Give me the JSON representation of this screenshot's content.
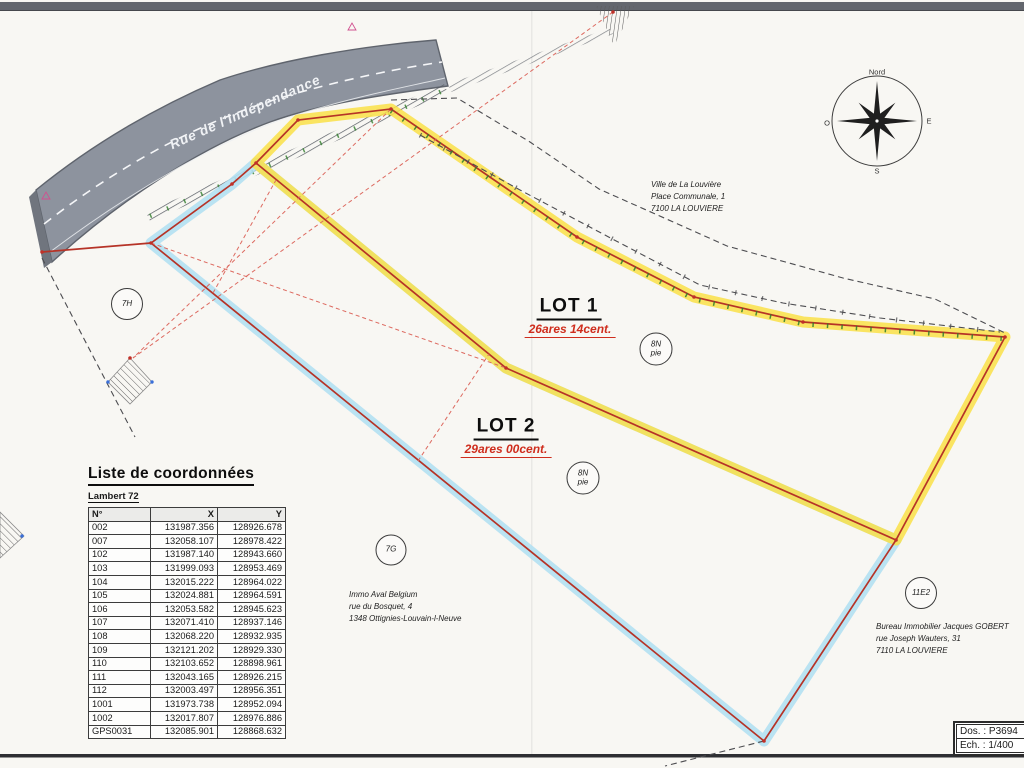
{
  "plan": {
    "road_name": "Rue de l'Indépendance",
    "dossier_label": "Dos. : P3694",
    "scale_label": "Ech. : 1/400",
    "compass": {
      "n": "Nord",
      "e": "E",
      "s": "S",
      "o": "O"
    },
    "lot1": {
      "name": "LOT 1",
      "area": "26ares 14cent."
    },
    "lot2": {
      "name": "LOT 2",
      "area": "29ares 00cent."
    }
  },
  "addresses": [
    {
      "l1": "Ville de La Louvière",
      "l2": "Place Communale, 1",
      "l3": "7100 LA LOUVIERE",
      "x": 651,
      "y": 179
    },
    {
      "l1": "Immo Aval Belgium",
      "l2": "rue du Bosquet, 4",
      "l3": "1348 Ottignies-Louvain-l-Neuve",
      "x": 349,
      "y": 589
    },
    {
      "l1": "Bureau Immobilier Jacques GOBERT",
      "l2": "rue Joseph Wauters, 31",
      "l3": "7110 LA LOUVIERE",
      "x": 876,
      "y": 621
    }
  ],
  "circles": [
    {
      "l1": "7H",
      "l2": "",
      "x": 127,
      "y": 304,
      "d": 30
    },
    {
      "l1": "7G",
      "l2": "",
      "x": 391,
      "y": 550,
      "d": 29
    },
    {
      "l1": "8N",
      "l2": "pie",
      "x": 656,
      "y": 349,
      "d": 31
    },
    {
      "l1": "8N",
      "l2": "pie",
      "x": 583,
      "y": 478,
      "d": 31
    },
    {
      "l1": "11E2",
      "l2": "",
      "x": 921,
      "y": 593,
      "d": 30
    }
  ],
  "labels": {
    "points": [
      {
        "t": "105 PL",
        "x": 401,
        "y": 98
      },
      {
        "t": "PL 104",
        "x": 312,
        "y": 106
      },
      {
        "t": "112 NBFJ",
        "x": 276,
        "y": 160
      },
      {
        "t": "à poser",
        "x": 279,
        "y": 170,
        "cls": "sm"
      },
      {
        "t": "103",
        "x": 222,
        "y": 189
      },
      {
        "t": "PL",
        "x": 220,
        "y": 198
      },
      {
        "t": "PL",
        "x": 120,
        "y": 238
      },
      {
        "t": "102",
        "x": 119,
        "y": 247
      },
      {
        "t": "PL",
        "x": 576,
        "y": 220
      },
      {
        "t": "106",
        "x": 589,
        "y": 228
      },
      {
        "t": "107",
        "x": 690,
        "y": 293
      },
      {
        "t": "PL",
        "x": 701,
        "y": 302
      },
      {
        "t": "108",
        "x": 799,
        "y": 317
      },
      {
        "t": "PL",
        "x": 803,
        "y": 327
      },
      {
        "t": "PL 109",
        "x": 1008,
        "y": 325
      },
      {
        "t": "110 NBFJ",
        "x": 926,
        "y": 544
      },
      {
        "t": "à poser",
        "x": 921,
        "y": 555,
        "cls": "sm"
      },
      {
        "t": "111 NBFJ",
        "x": 524,
        "y": 352
      },
      {
        "t": "à poser",
        "x": 527,
        "y": 362,
        "cls": "sm"
      },
      {
        "t": "GPS0031",
        "x": 802,
        "y": 744
      },
      {
        "t": "PL",
        "x": 787,
        "y": 753
      },
      {
        "t": "007",
        "x": 622,
        "y": 12
      },
      {
        "t": "Coin bât",
        "x": 631,
        "y": 22
      },
      {
        "t": "Coin bât",
        "x": 119,
        "y": 341
      },
      {
        "t": "002",
        "x": 113,
        "y": 350
      }
    ],
    "red_measures": [
      {
        "t": "9.88",
        "x": 344,
        "y": 114,
        "r": -8
      },
      {
        "t": "14.01",
        "x": 289,
        "y": 142,
        "r": -42
      },
      {
        "t": "5.26",
        "x": 233,
        "y": 172,
        "r": -39
      },
      {
        "t": "18.46",
        "x": 177,
        "y": 213,
        "r": -38
      },
      {
        "t": "6.17",
        "x": 113,
        "y": 261,
        "r": -47
      },
      {
        "t": "17.49",
        "x": 62,
        "y": 306,
        "r": -56
      },
      {
        "t": "20.00",
        "x": 254,
        "y": 262,
        "r": -56
      },
      {
        "t": "18.50",
        "x": 338,
        "y": 149,
        "r": -62
      },
      {
        "t": "87.65",
        "x": 364,
        "y": 182,
        "r": -40
      },
      {
        "t": "48.82",
        "x": 375,
        "y": 256,
        "r": -40
      },
      {
        "t": "20.00",
        "x": 454,
        "y": 407,
        "r": -58
      },
      {
        "t": "124.03",
        "x": 450,
        "y": 487,
        "r": 40
      },
      {
        "t": "34.40",
        "x": 484,
        "y": 161,
        "r": 34
      },
      {
        "t": "19.74",
        "x": 613,
        "y": 258,
        "r": 28
      },
      {
        "t": "17.33",
        "x": 744,
        "y": 306,
        "r": 13
      },
      {
        "t": "33.18",
        "x": 908,
        "y": 320,
        "r": 5
      },
      {
        "t": "86.24",
        "x": 703,
        "y": 442,
        "r": 26
      },
      {
        "t": "35.11",
        "x": 940,
        "y": 431,
        "r": -62
      },
      {
        "t": "35.11",
        "x": 837,
        "y": 630,
        "r": -57
      }
    ],
    "orange_measures": [
      {
        "t": "77.17",
        "x": 464,
        "y": 95,
        "r": 0
      },
      {
        "t": "80.83",
        "x": 367,
        "y": 117,
        "r": -12
      },
      {
        "t": "60.95",
        "x": 401,
        "y": 134,
        "r": -12
      },
      {
        "t": "61.38",
        "x": 454,
        "y": 172,
        "r": -10
      },
      {
        "t": "81.71",
        "x": 519,
        "y": 209,
        "r": -10
      },
      {
        "t": "81.96",
        "x": 575,
        "y": 242,
        "r": -9
      },
      {
        "t": "82.15",
        "x": 639,
        "y": 274,
        "r": -8
      },
      {
        "t": "77.62",
        "x": 531,
        "y": 142,
        "r": -5
      },
      {
        "t": "78.12",
        "x": 599,
        "y": 189,
        "r": -5
      },
      {
        "t": "78.42",
        "x": 724,
        "y": 243,
        "r": -4
      },
      {
        "t": "79.19",
        "x": 842,
        "y": 277,
        "r": -3
      },
      {
        "t": "79.75",
        "x": 936,
        "y": 298,
        "r": -3
      },
      {
        "t": "80.19",
        "x": 1008,
        "y": 312,
        "r": -3
      },
      {
        "t": "83.23",
        "x": 910,
        "y": 341,
        "r": 4
      }
    ],
    "pink_points": [
      {
        "t": "1002",
        "x": 331,
        "y": 24
      },
      {
        "t": "1001",
        "x": 40,
        "y": 181
      }
    ]
  },
  "coordinates_table": {
    "title": "Liste de coordonnées",
    "subtitle": "Lambert 72",
    "headers": [
      "N°",
      "X",
      "Y"
    ],
    "rows": [
      [
        "002",
        "131987.356",
        "128926.678"
      ],
      [
        "007",
        "132058.107",
        "128978.422"
      ],
      [
        "102",
        "131987.140",
        "128943.660"
      ],
      [
        "103",
        "131999.093",
        "128953.469"
      ],
      [
        "104",
        "132015.222",
        "128964.022"
      ],
      [
        "105",
        "132024.881",
        "128964.591"
      ],
      [
        "106",
        "132053.582",
        "128945.623"
      ],
      [
        "107",
        "132071.410",
        "128937.146"
      ],
      [
        "108",
        "132068.220",
        "128932.935"
      ],
      [
        "109",
        "132121.202",
        "128929.330"
      ],
      [
        "110",
        "132103.652",
        "128898.961"
      ],
      [
        "111",
        "132043.165",
        "128926.215"
      ],
      [
        "112",
        "132003.497",
        "128956.351"
      ],
      [
        "1001",
        "131973.738",
        "128952.094"
      ],
      [
        "1002",
        "132017.807",
        "128976.886"
      ],
      [
        "GPS0031",
        "132085.901",
        "128868.632"
      ]
    ]
  }
}
